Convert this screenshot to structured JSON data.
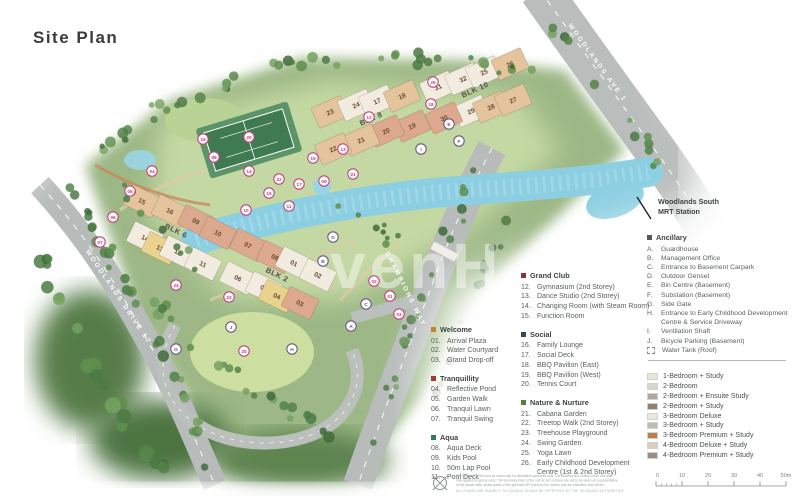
{
  "page": {
    "title": "Site Plan",
    "watermark": "venH"
  },
  "map": {
    "road_labels": [
      {
        "text": "WOODLANDS AVE 1",
        "x": 596,
        "y": 64,
        "rot": 54
      },
      {
        "text": "WOODLANDS DRIVE 17",
        "x": 117,
        "y": 298,
        "rot": 56
      },
      {
        "text": "CHAMPIONS WAY",
        "x": 404,
        "y": 290,
        "rot": 63
      }
    ],
    "mrt": {
      "line1": "Woodlands South",
      "line2": "MRT Station"
    },
    "blocks": [
      {
        "t": "23",
        "x": 330,
        "y": 112,
        "r": -24,
        "f": "#e3c49c"
      },
      {
        "t": "24",
        "x": 356,
        "y": 105,
        "r": -24,
        "f": "#f2ece0"
      },
      {
        "t": "17",
        "x": 377,
        "y": 101,
        "r": -24,
        "f": "#f2ece0"
      },
      {
        "t": "18",
        "x": 402,
        "y": 96,
        "r": -24,
        "f": "#e3c49c"
      },
      {
        "t": "31",
        "x": 438,
        "y": 87,
        "r": -24,
        "f": "#f2ece0"
      },
      {
        "t": "32",
        "x": 463,
        "y": 79,
        "r": -24,
        "f": "#f2ece0"
      },
      {
        "t": "25",
        "x": 484,
        "y": 72,
        "r": -24,
        "f": "#f2ece0"
      },
      {
        "t": "26",
        "x": 510,
        "y": 64,
        "r": -24,
        "f": "#e3c49c"
      },
      {
        "t": "29",
        "x": 471,
        "y": 111,
        "r": -24,
        "f": "#f2ece0"
      },
      {
        "t": "28",
        "x": 491,
        "y": 107,
        "r": -24,
        "f": "#e3c49c"
      },
      {
        "t": "27",
        "x": 513,
        "y": 100,
        "r": -24,
        "f": "#e3c49c"
      },
      {
        "t": "19",
        "x": 412,
        "y": 126,
        "r": -24,
        "f": "#dca88e"
      },
      {
        "t": "30",
        "x": 444,
        "y": 118,
        "r": -24,
        "f": "#dca88e"
      },
      {
        "t": "20",
        "x": 386,
        "y": 131,
        "r": -24,
        "f": "#dca88e"
      },
      {
        "t": "21",
        "x": 361,
        "y": 140,
        "r": -24,
        "f": "#e3c49c"
      },
      {
        "t": "22",
        "x": 333,
        "y": 149,
        "r": -24,
        "f": "#e3c49c"
      },
      {
        "t": "15",
        "x": 142,
        "y": 201,
        "r": 26,
        "f": "#e3c49c"
      },
      {
        "t": "16",
        "x": 170,
        "y": 211,
        "r": 26,
        "f": "#e3c49c"
      },
      {
        "t": "09",
        "x": 196,
        "y": 221,
        "r": 26,
        "f": "#dca88e"
      },
      {
        "t": "14",
        "x": 145,
        "y": 238,
        "r": 26,
        "f": "#f2ece0"
      },
      {
        "t": "13",
        "x": 160,
        "y": 248,
        "r": 26,
        "f": "#e8d28e"
      },
      {
        "t": "12",
        "x": 178,
        "y": 252,
        "r": 26,
        "f": "#f2ece0"
      },
      {
        "t": "10",
        "x": 218,
        "y": 233,
        "r": 26,
        "f": "#dca88e"
      },
      {
        "t": "07",
        "x": 248,
        "y": 245,
        "r": 26,
        "f": "#dca88e"
      },
      {
        "t": "11",
        "x": 203,
        "y": 264,
        "r": 26,
        "f": "#f2ece0"
      },
      {
        "t": "08",
        "x": 275,
        "y": 257,
        "r": 26,
        "f": "#dca88e"
      },
      {
        "t": "06",
        "x": 238,
        "y": 278,
        "r": 26,
        "f": "#f2ece0"
      },
      {
        "t": "01",
        "x": 294,
        "y": 263,
        "r": 26,
        "f": "#f2ece0"
      },
      {
        "t": "02",
        "x": 318,
        "y": 275,
        "r": 26,
        "f": "#f2ece0"
      },
      {
        "t": "05",
        "x": 264,
        "y": 288,
        "r": 26,
        "f": "#f2ece0"
      },
      {
        "t": "04",
        "x": 277,
        "y": 296,
        "r": 26,
        "f": "#e8d28e"
      },
      {
        "t": "03",
        "x": 300,
        "y": 303,
        "r": 26,
        "f": "#dca88e"
      }
    ],
    "blk_labels": [
      {
        "t": "BLK 8",
        "x": 372,
        "y": 121,
        "r": -24
      },
      {
        "t": "BLK 10",
        "x": 476,
        "y": 92,
        "r": -24
      },
      {
        "t": "BLK 6",
        "x": 175,
        "y": 233,
        "r": 26
      },
      {
        "t": "BLK 2",
        "x": 276,
        "y": 277,
        "r": 26
      }
    ],
    "amenity_markers": [
      {
        "t": "01",
        "x": 390,
        "y": 296
      },
      {
        "t": "02",
        "x": 374,
        "y": 281
      },
      {
        "t": "03",
        "x": 399,
        "y": 314
      },
      {
        "t": "04",
        "x": 152,
        "y": 171
      },
      {
        "t": "05",
        "x": 130,
        "y": 191
      },
      {
        "t": "06",
        "x": 113,
        "y": 217
      },
      {
        "t": "07",
        "x": 100,
        "y": 242
      },
      {
        "t": "08",
        "x": 214,
        "y": 157
      },
      {
        "t": "09",
        "x": 324,
        "y": 181
      },
      {
        "t": "10",
        "x": 246,
        "y": 210
      },
      {
        "t": "11",
        "x": 289,
        "y": 206
      },
      {
        "t": "12",
        "x": 369,
        "y": 117
      },
      {
        "t": "13",
        "x": 343,
        "y": 149
      },
      {
        "t": "14",
        "x": 249,
        "y": 171
      },
      {
        "t": "15",
        "x": 313,
        "y": 158
      },
      {
        "t": "16",
        "x": 269,
        "y": 193
      },
      {
        "t": "17",
        "x": 299,
        "y": 184
      },
      {
        "t": "18",
        "x": 431,
        "y": 104
      },
      {
        "t": "19",
        "x": 203,
        "y": 139
      },
      {
        "t": "20",
        "x": 249,
        "y": 137
      },
      {
        "t": "21",
        "x": 353,
        "y": 174
      },
      {
        "t": "22",
        "x": 279,
        "y": 179
      },
      {
        "t": "23",
        "x": 229,
        "y": 297
      },
      {
        "t": "24",
        "x": 176,
        "y": 285
      },
      {
        "t": "25",
        "x": 244,
        "y": 351
      },
      {
        "t": "26",
        "x": 433,
        "y": 82
      }
    ],
    "ancillary_markers": [
      {
        "t": "A",
        "x": 351,
        "y": 326
      },
      {
        "t": "B",
        "x": 323,
        "y": 261
      },
      {
        "t": "C",
        "x": 366,
        "y": 304
      },
      {
        "t": "D",
        "x": 333,
        "y": 237
      },
      {
        "t": "E",
        "x": 449,
        "y": 124
      },
      {
        "t": "F",
        "x": 459,
        "y": 141
      },
      {
        "t": "G",
        "x": 176,
        "y": 349
      },
      {
        "t": "H",
        "x": 292,
        "y": 349
      },
      {
        "t": "I",
        "x": 421,
        "y": 149
      },
      {
        "t": "J",
        "x": 231,
        "y": 327
      }
    ]
  },
  "legend": {
    "col1": [
      {
        "title": "Welcome",
        "bullet": "#c08433",
        "items": [
          {
            "n": "01.",
            "label": "Arrival Plaza"
          },
          {
            "n": "02.",
            "label": "Water Courtyard"
          },
          {
            "n": "03.",
            "label": "Grand Drop-off"
          }
        ]
      },
      {
        "title": "Tranquillity",
        "bullet": "#a93a32",
        "items": [
          {
            "n": "04.",
            "label": "Reflective Pond"
          },
          {
            "n": "05.",
            "label": "Garden Walk"
          },
          {
            "n": "06.",
            "label": "Tranquil Lawn"
          },
          {
            "n": "07.",
            "label": "Tranquil Swing"
          }
        ]
      },
      {
        "title": "Aqua",
        "bullet": "#2f7d52",
        "items": [
          {
            "n": "08.",
            "label": "Aqua Deck"
          },
          {
            "n": "09.",
            "label": "Kids Pool"
          },
          {
            "n": "10.",
            "label": "50m Lap Pool"
          },
          {
            "n": "11.",
            "label": "Pool Deck"
          }
        ]
      }
    ],
    "col2": [
      {
        "title": "Grand Club",
        "bullet": "#8e2f3c",
        "items": [
          {
            "n": "12.",
            "label": "Gymnasium (2nd Storey)"
          },
          {
            "n": "13.",
            "label": "Dance Studio (2nd Storey)"
          },
          {
            "n": "14.",
            "label": "Changing Room (with Steam Room)"
          },
          {
            "n": "15.",
            "label": "Function Room"
          }
        ]
      },
      {
        "title": "Social",
        "bullet": "#3a4560",
        "items": [
          {
            "n": "16.",
            "label": "Family Lounge"
          },
          {
            "n": "17.",
            "label": "Social Deck"
          },
          {
            "n": "18.",
            "label": "BBQ Pavilion (East)"
          },
          {
            "n": "19.",
            "label": "BBQ Pavilion (West)"
          },
          {
            "n": "20.",
            "label": "Tennis Court"
          }
        ]
      },
      {
        "title": "Nature & Nurture",
        "bullet": "#55803c",
        "items": [
          {
            "n": "21.",
            "label": "Cabana Garden"
          },
          {
            "n": "22.",
            "label": "Treetop Walk (2nd Storey)"
          },
          {
            "n": "23.",
            "label": "Treehouse Playground"
          },
          {
            "n": "24.",
            "label": "Swing Garden"
          },
          {
            "n": "25.",
            "label": "Yoga Lawn"
          },
          {
            "n": "26.",
            "label": "Early Childhood Development Centre (1st & 2nd Storey)"
          }
        ]
      }
    ],
    "ancillary": {
      "title": "Ancillary",
      "bullet": "#55595a",
      "items": [
        {
          "n": "A.",
          "label": "Guardhouse"
        },
        {
          "n": "B.",
          "label": "Management Office"
        },
        {
          "n": "C.",
          "label": "Entrance to Basement Carpark"
        },
        {
          "n": "D.",
          "label": "Outdoor Genset"
        },
        {
          "n": "E.",
          "label": "Bin Centre (Basement)"
        },
        {
          "n": "F.",
          "label": "Substation (Basement)"
        },
        {
          "n": "G.",
          "label": "Side Gate"
        },
        {
          "n": "H.",
          "label": "Entrance to Early Childhood Development Centre & Service Driveway"
        },
        {
          "n": "I.",
          "label": "Ventilation Shaft"
        },
        {
          "n": "J.",
          "label": "Bicycle Parking (Basement)"
        },
        {
          "n": "",
          "icon": "dashed-square",
          "label": "Water Tank (Roof)"
        }
      ]
    }
  },
  "unit_types": [
    {
      "color": "#e7ead2",
      "label": "1-Bedroom + Study"
    },
    {
      "color": "#d9d6cb",
      "label": "2-Bedroom"
    },
    {
      "color": "#b3a99a",
      "label": "2-Bedroom + Ensuite Study"
    },
    {
      "color": "#8c8173",
      "label": "2-Bedroom + Study"
    },
    {
      "color": "#eae7df",
      "label": "3-Bedroom Deluxe"
    },
    {
      "color": "#c2bcb0",
      "label": "3-Bedroom + Study"
    },
    {
      "color": "#bd7e4e",
      "label": "3-Bedroom Premium + Study"
    },
    {
      "color": "#d6cfc2",
      "label": "4-Bedroom Deluxe + Study"
    },
    {
      "color": "#97907e",
      "label": "4-Bedroom Premium + Study"
    }
  ],
  "scale_bar": {
    "ticks": [
      "0",
      "10",
      "20",
      "30",
      "40",
      "50m"
    ]
  },
  "disclaimer": {
    "lines": [
      "The design/s of this unit as shown are for illustrative purposes only. The drawing and outline of the unit type",
      "only applies to typical units. The boundary lines of the unit as set out here are not to be taken as representative",
      "of the actual units, strata areas or the approved BP plans by the vendor and are indicative only herein.",
      "ALL PLANS ARE SUBJECT TO CHANGE AS MAY BE APPROVED BY THE RELEVANT AUTHORITIES"
    ]
  }
}
